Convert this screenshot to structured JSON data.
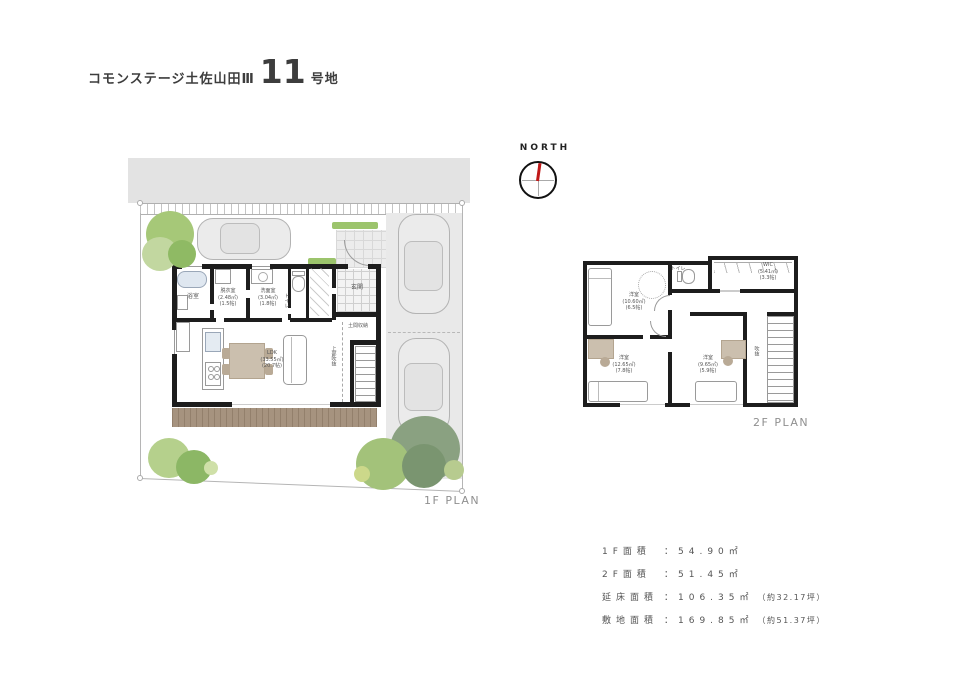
{
  "header": {
    "project_name": "コモンステージ土佐山田Ⅲ",
    "lot_number": "11",
    "lot_unit": "号地"
  },
  "compass": {
    "label": "NORTH"
  },
  "plan_1f": {
    "caption": "1F PLAN",
    "labels": {
      "bath": "浴室",
      "laundry": "脱衣室\n(2.48㎡)\n(1.5帖)",
      "washroom": "洗面室\n(3.04㎡)\n(1.8帖)",
      "toilet": "トイレ",
      "entrance": "玄関",
      "doma_storage": "土間収納",
      "void_above": "上部吹抜",
      "ldk": "LDK\n(33.55㎡)\n(20.7帖)"
    }
  },
  "plan_2f": {
    "caption": "2F PLAN",
    "labels": {
      "bedroom_nw": "洋室\n(10.60㎡)\n(6.5帖)",
      "toilet": "トイレ",
      "wic": "WIC\n(5.41㎡)\n(3.3帖)",
      "room_sw": "洋室\n(12.65㎡)\n(7.8帖)",
      "room_se": "洋室\n(9.65㎡)\n(5.9帖)",
      "void": "吹抜"
    }
  },
  "area_table": {
    "rows": [
      {
        "label": "1F面積",
        "colon": "：",
        "value": "54.90㎡",
        "note": ""
      },
      {
        "label": "2F面積",
        "colon": "：",
        "value": "51.45㎡",
        "note": ""
      },
      {
        "label": "延床面積",
        "colon": "：",
        "value": "106.35㎡",
        "note": "（約32.17坪）"
      },
      {
        "label": "敷地面積",
        "colon": "：",
        "value": "169.85㎡",
        "note": "（約51.37坪）"
      }
    ]
  },
  "colors": {
    "road_gray": "#e3e3e3",
    "driveway_gray": "#e9e9e9",
    "wall_black": "#1d1d1d",
    "deck_brown": "#a6937f",
    "tree_green_light": "#b5d08c",
    "tree_green_mid": "#8fba64",
    "tree_green_gray": "#8aa181",
    "needle_red": "#c01818",
    "tub_blue": "#dfe7f0"
  }
}
